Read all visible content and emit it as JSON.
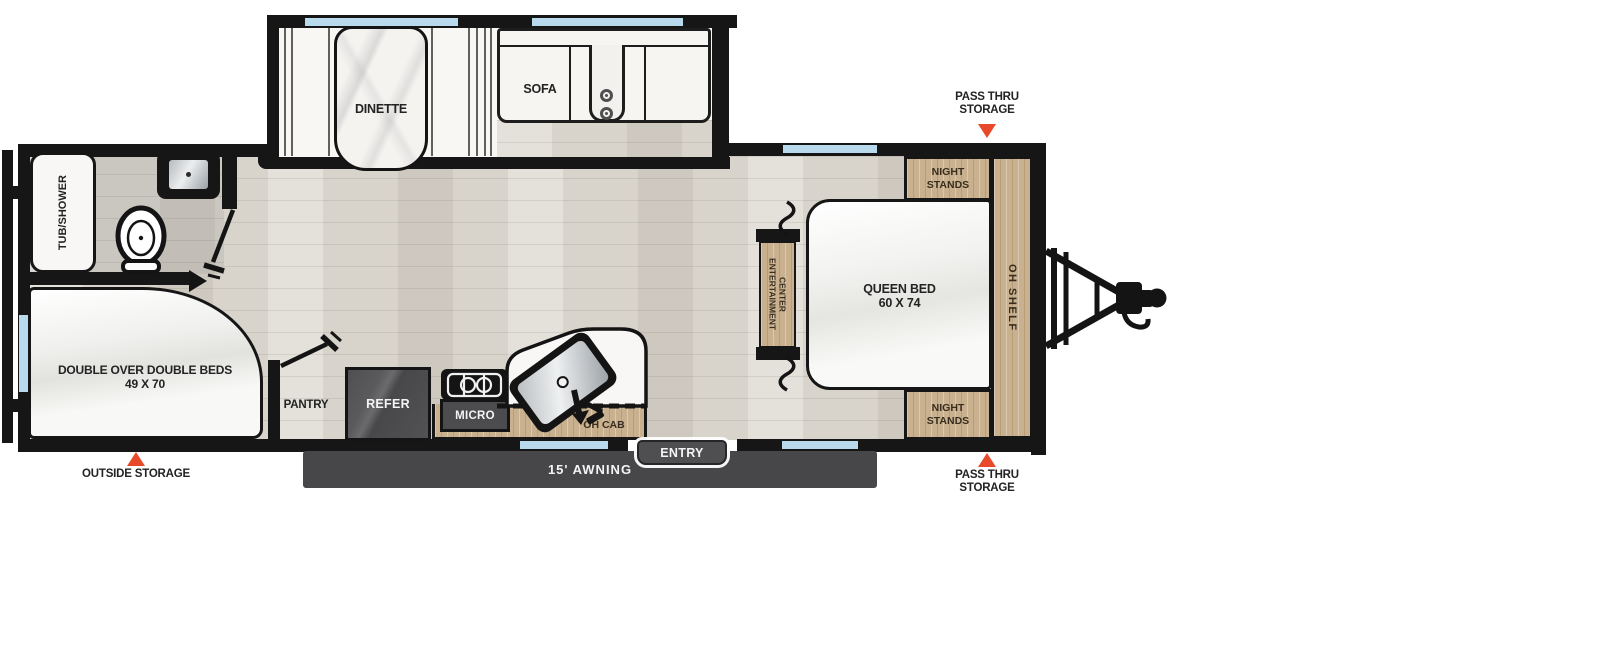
{
  "colors": {
    "wall_black": "#161616",
    "wood_tan": "#c9b18f",
    "floor_laminate": "#d8d4cc",
    "bath_floor": "#cac7c1",
    "dark_gray_fixture": "#4c4c4f",
    "awning_gray": "#47474a",
    "window_blue": "#b9d9ec",
    "marker_red": "#e8492b"
  },
  "labels": {
    "tub_shower": "TUB/SHOWER",
    "dinette": "DINETTE",
    "sofa": "SOFA",
    "double_beds": [
      "DOUBLE OVER DOUBLE BEDS",
      "49 X 70"
    ],
    "pantry": "PANTRY",
    "refer": "REFER",
    "micro": "MICRO",
    "oh_cab": "OH CAB",
    "entry": "ENTRY",
    "awning": "15' AWNING",
    "outside_storage": "OUTSIDE STORAGE",
    "pass_thru_top": [
      "PASS THRU",
      "STORAGE"
    ],
    "pass_thru_bottom": [
      "PASS THRU",
      "STORAGE"
    ],
    "night_stands_top": [
      "NIGHT",
      "STANDS"
    ],
    "night_stands_bottom": [
      "NIGHT",
      "STANDS"
    ],
    "queen_bed": [
      "QUEEN BED",
      "60 X 74"
    ],
    "oh_shelf": "OH SHELF",
    "entertainment_center": [
      "ENTERTAINMENT",
      "CENTER"
    ]
  }
}
